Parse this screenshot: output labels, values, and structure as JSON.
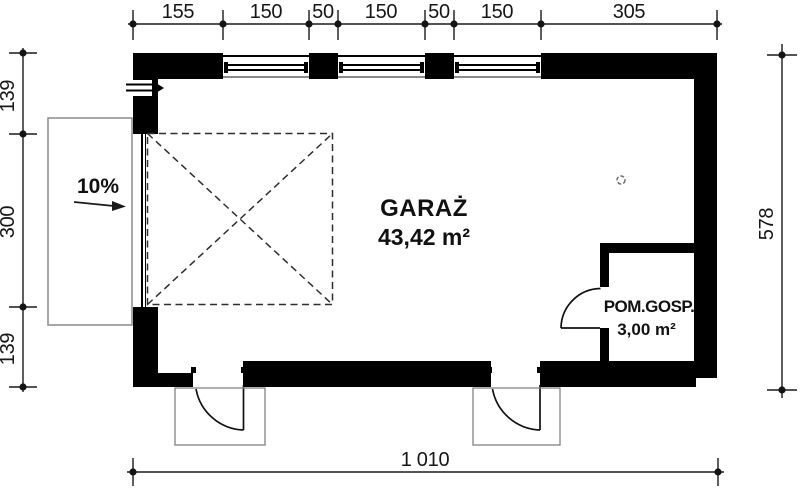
{
  "rooms": {
    "garage": {
      "name": "GARAŻ",
      "area": "43,42 m²"
    },
    "utility": {
      "name": "POM.GOSP.",
      "area": "3,00 m²"
    }
  },
  "annotations": {
    "driveway_slope": "10%"
  },
  "dimensions": {
    "top": [
      "155",
      "150",
      "50",
      "150",
      "50",
      "150",
      "305"
    ],
    "left": [
      "139",
      "300",
      "139"
    ],
    "right": "578",
    "bottom": "1 010"
  },
  "symbols": {
    "entrance_arrow": "entrance-direction-arrow",
    "floor_drain": "floor-drain-circle",
    "parking_space": "dashed-car-space-with-x",
    "garage_gate": "double-line-gate",
    "window_count": 3,
    "door_count": 3
  },
  "colors": {
    "wall": "#000000",
    "line": "#1a1a1a",
    "secondary_line": "#8a8a8a",
    "background": "#ffffff"
  }
}
